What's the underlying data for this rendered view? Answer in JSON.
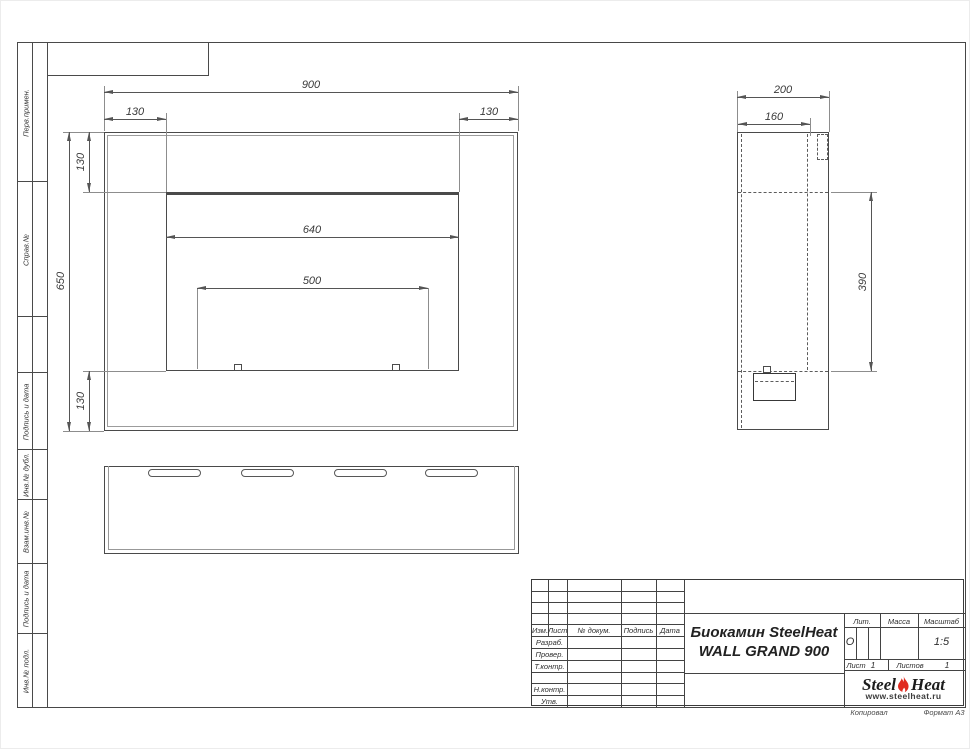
{
  "drawing": {
    "title_line1": "Биокамин SteelHeat",
    "title_line2": "WALL GRAND 900"
  },
  "dims": {
    "front_width": "900",
    "front_left_offset": "130",
    "front_right_offset": "130",
    "front_height": "650",
    "front_top_offset": "130",
    "front_bottom_offset": "130",
    "opening_width": "640",
    "burner_width": "500",
    "side_depth": "200",
    "side_inner_depth": "160",
    "side_opening_height": "390"
  },
  "margin": {
    "items": [
      {
        "label": "Перв.примен."
      },
      {
        "label": "Справ.№"
      },
      {
        "label": ""
      },
      {
        "label": "Подпись и дата"
      },
      {
        "label": "Инв.№ дубл."
      },
      {
        "label": "Взам.инв.№"
      },
      {
        "label": "Подпись и дата"
      },
      {
        "label": "Инв.№ подл."
      }
    ]
  },
  "title_block": {
    "rev_headers": {
      "izm": "Изм.",
      "list": "Лист",
      "doc": "№ докум.",
      "sign": "Подпись",
      "date": "Дата"
    },
    "roles": [
      "Разраб.",
      "Провер.",
      "Т.контр.",
      "Н.контр.",
      "Утв."
    ],
    "lit_label": "Лит.",
    "lit_value": "О",
    "mass_label": "Масса",
    "scale_label": "Масштаб",
    "scale_value": "1:5",
    "sheet_label": "Лист",
    "sheet_value": "1",
    "sheets_label": "Листов",
    "sheets_value": "1"
  },
  "logo": {
    "part1": "Steel",
    "part2": "Heat",
    "url": "www.steelheat.ru",
    "flame_color": "#e02b20"
  },
  "footer": {
    "copied": "Копировал",
    "format": "Формат А3"
  }
}
